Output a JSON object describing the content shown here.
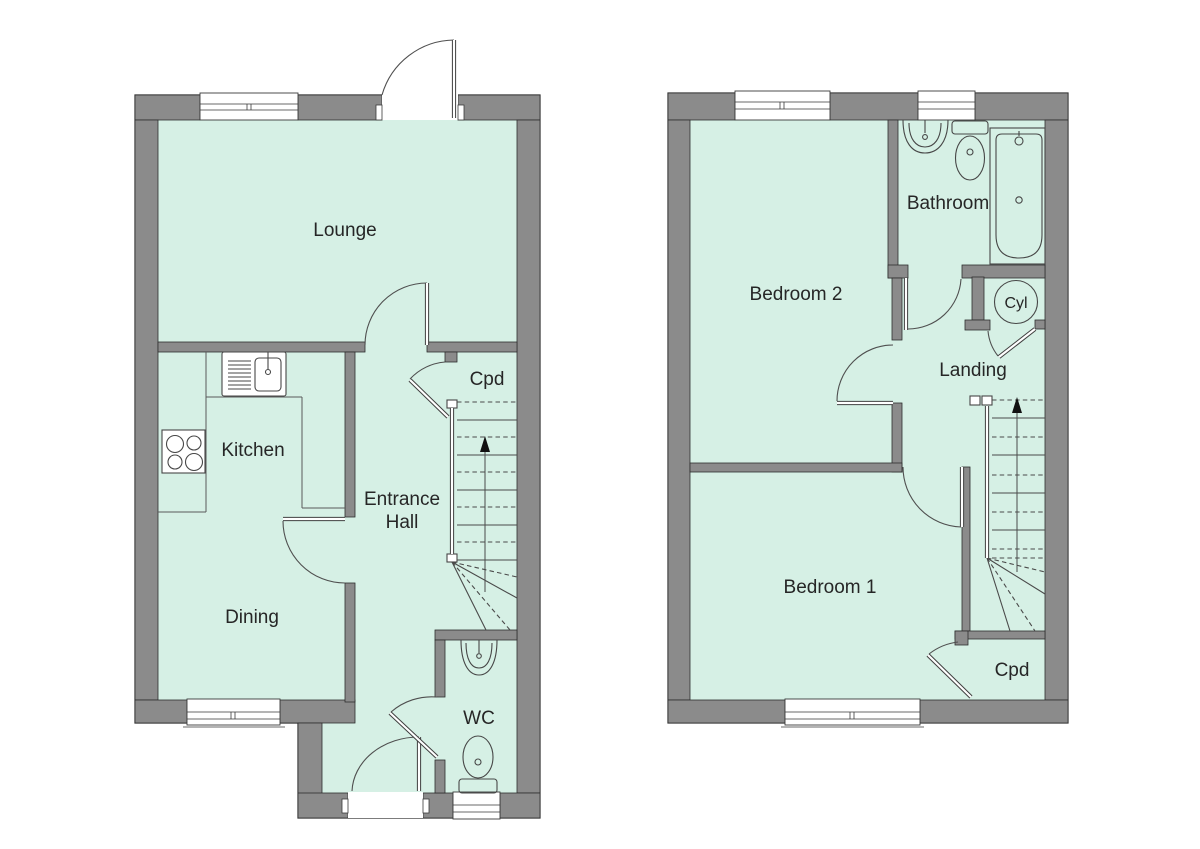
{
  "colors": {
    "floor": "#d6f0e5",
    "wall": "#8b8b8b",
    "outline": "#2d2d2d",
    "text": "#262626"
  },
  "ground_floor": {
    "labels": {
      "lounge": "Lounge",
      "kitchen": "Kitchen",
      "entrance_hall_line1": "Entrance",
      "entrance_hall_line2": "Hall",
      "cupboard": "Cpd",
      "dining": "Dining",
      "wc": "WC"
    }
  },
  "first_floor": {
    "labels": {
      "bedroom2": "Bedroom 2",
      "bathroom": "Bathroom",
      "cylinder_cupboard": "Cyl",
      "landing": "Landing",
      "bedroom1": "Bedroom 1",
      "cupboard": "Cpd"
    }
  }
}
